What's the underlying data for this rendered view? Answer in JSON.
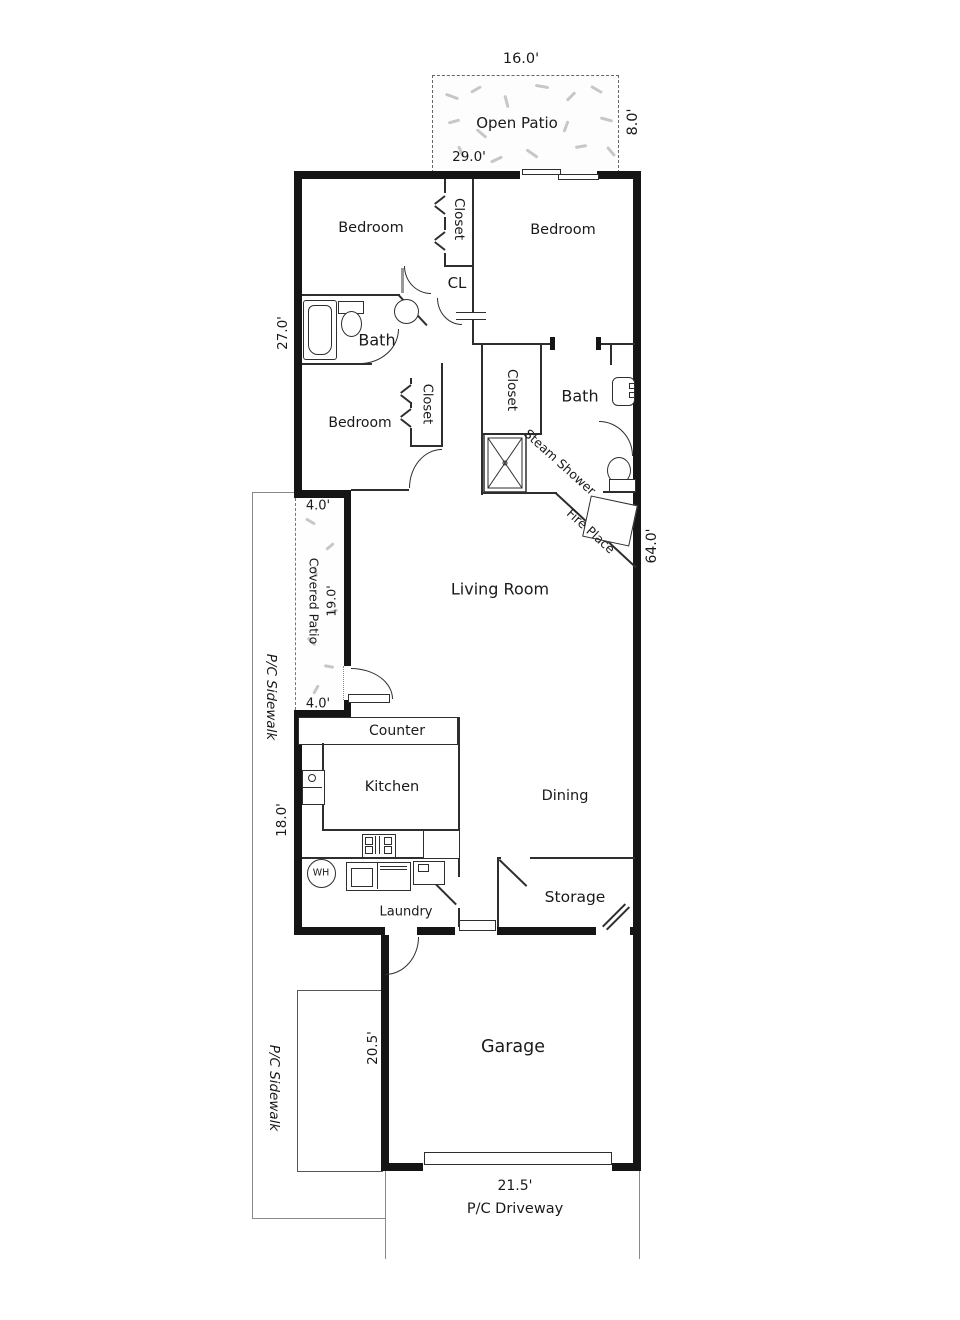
{
  "labels": {
    "open_patio": "Open Patio",
    "bedroom_top_left": "Bedroom",
    "bedroom_top_right": "Bedroom",
    "closet_top": "Closet",
    "cl": "CL",
    "bath_left": "Bath",
    "bedroom_mid": "Bedroom",
    "closet_mid": "Closet",
    "closet_right": "Closet",
    "bath_right": "Bath",
    "steam_shower": "Steam Shower",
    "fire_place": "Fire Place",
    "living_room": "Living Room",
    "covered_patio": "Covered Patio",
    "counter": "Counter",
    "kitchen": "Kitchen",
    "dining": "Dining",
    "laundry": "Laundry",
    "storage": "Storage",
    "garage": "Garage",
    "water_heater": "WH"
  },
  "dimensions": {
    "open_patio_width": "16.0'",
    "open_patio_depth": "8.0'",
    "house_width": "29.0'",
    "upper_depth": "27.0'",
    "covered_patio_width_top": "4.0'",
    "covered_patio_length": "19.0'",
    "covered_patio_width_bottom": "4.0'",
    "house_depth": "64.0'",
    "kitchen_depth": "18.0'",
    "garage_depth": "20.5'",
    "garage_door_width": "21.5'"
  },
  "site": {
    "sidewalk_upper": "P/C Sidewalk",
    "sidewalk_lower": "P/C Sidewalk",
    "driveway": "P/C Driveway"
  },
  "colors": {
    "wall": "#151515",
    "interior_line": "#2e2e2e",
    "site_line": "#8a8a8a",
    "texture": "#c7c7c7",
    "background": "#ffffff"
  }
}
